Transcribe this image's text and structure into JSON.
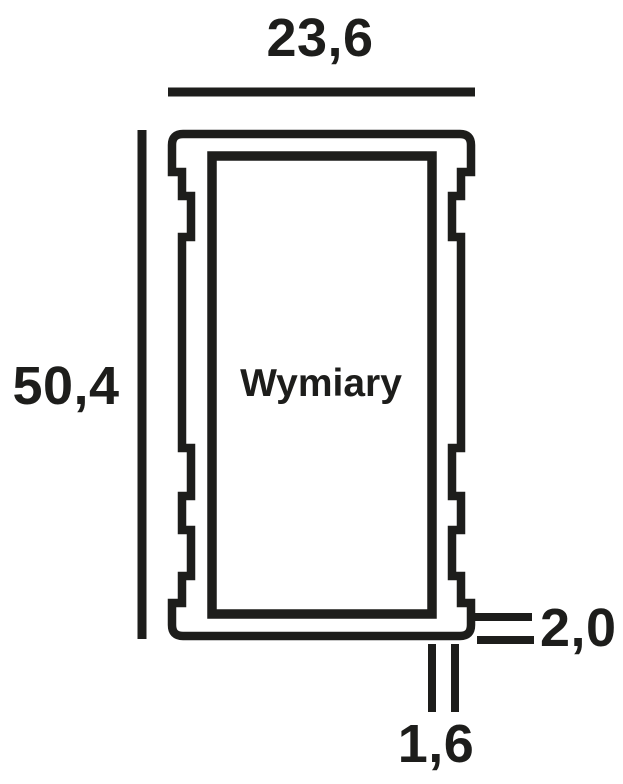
{
  "drawing": {
    "profile_name": "Wymiary",
    "dimensions": {
      "width": "23,6",
      "height": "50,4",
      "wall_bottom_thickness": "2,0",
      "wall_side_thickness": "1,6"
    },
    "colors": {
      "line": "#1d1d1b",
      "background": "#ffffff"
    }
  }
}
